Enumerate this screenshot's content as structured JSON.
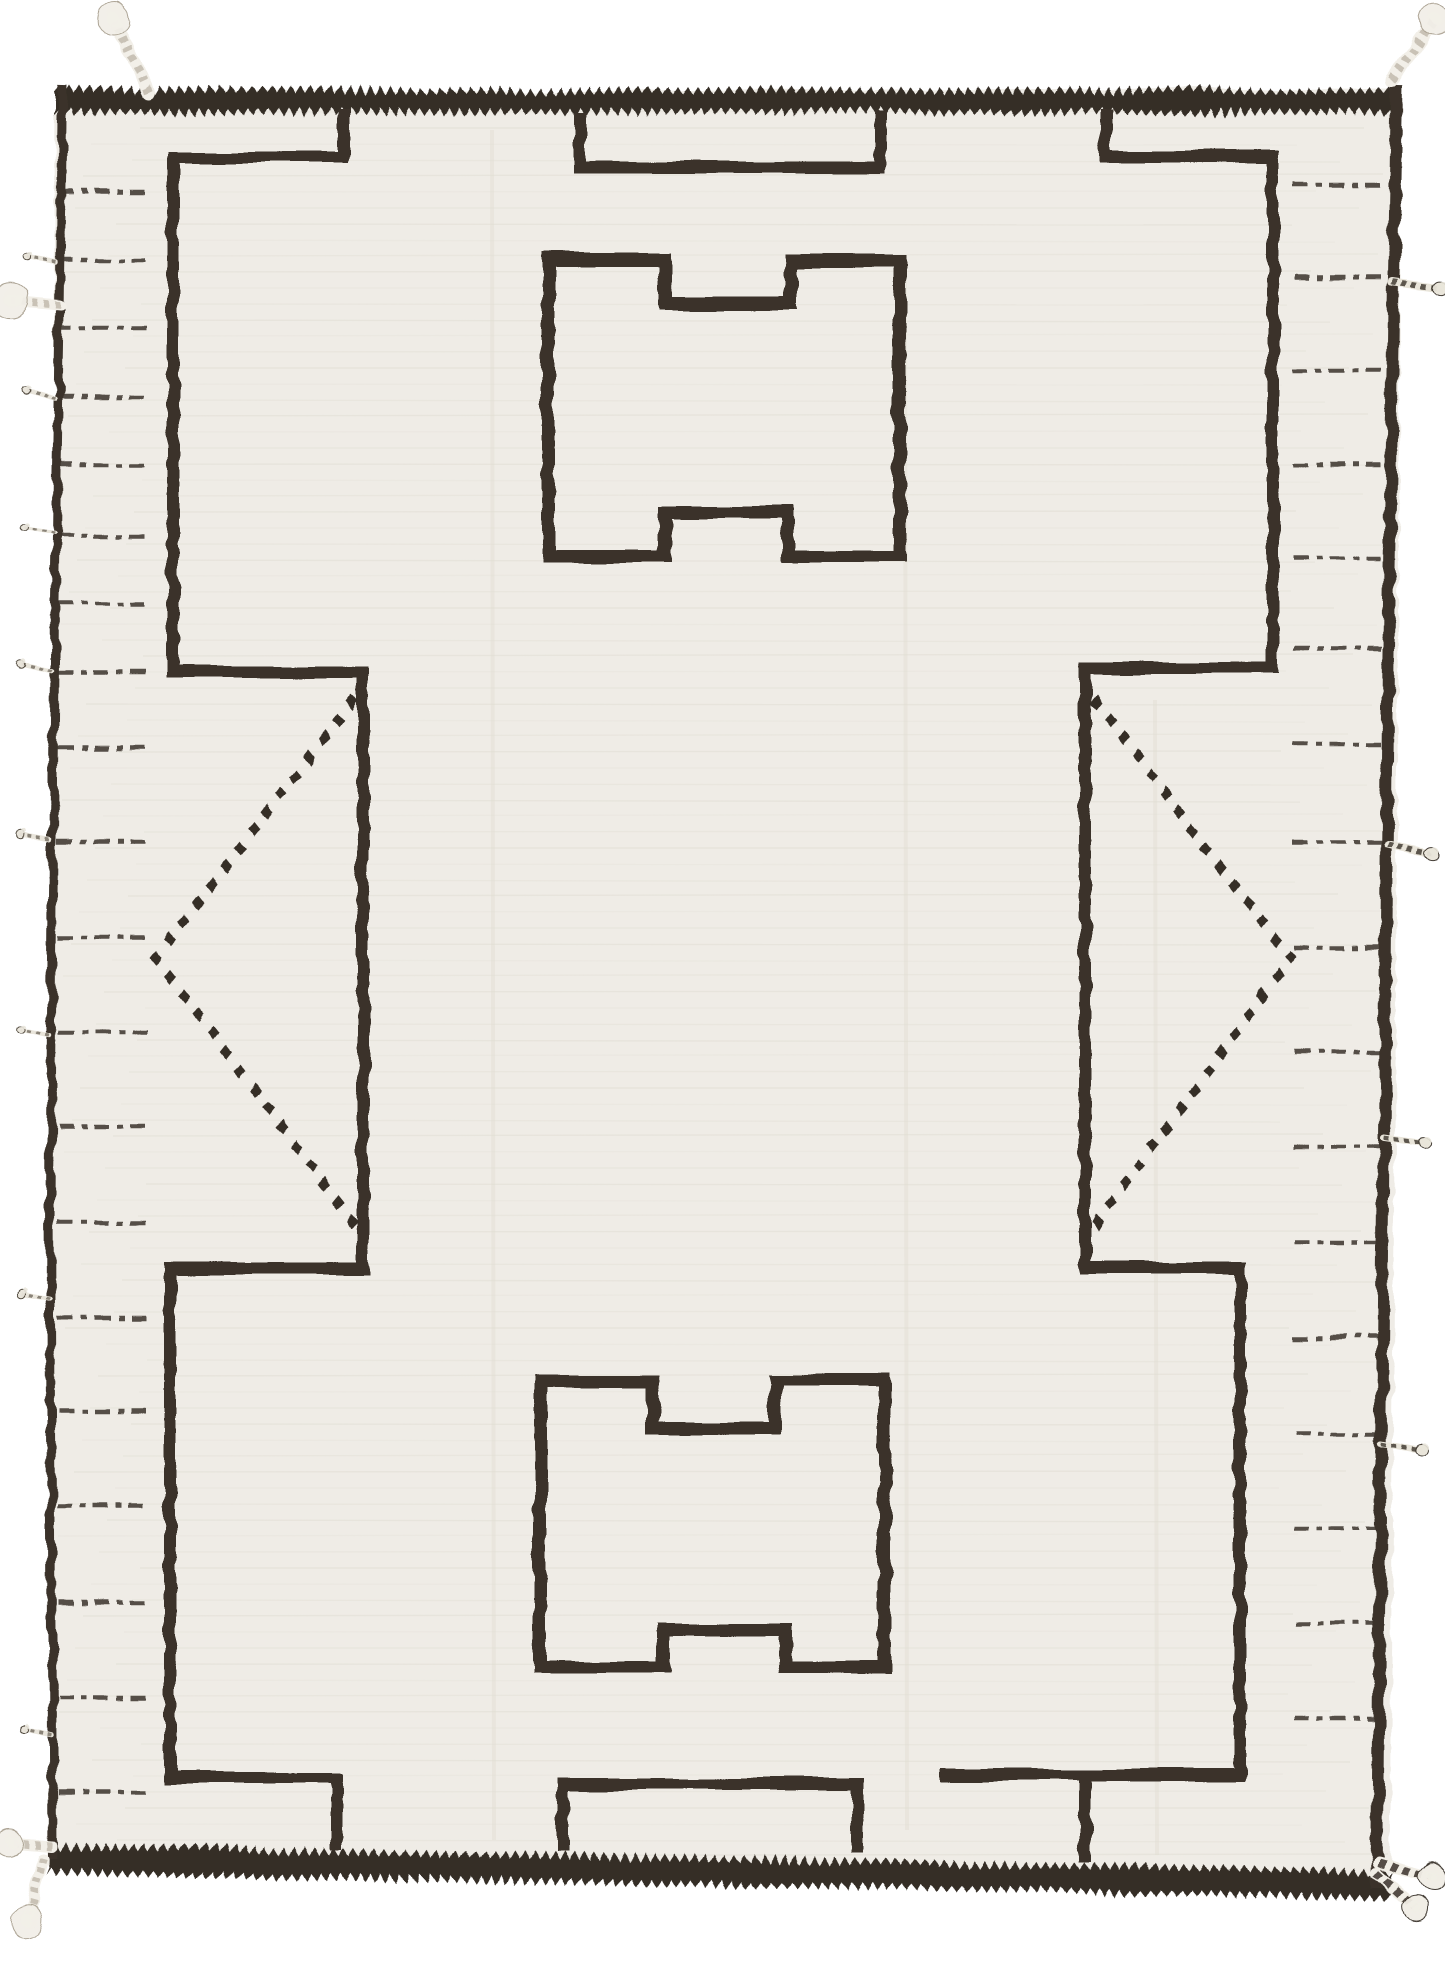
{
  "meta": {
    "title": "Moroccan Berber wool rug photograph",
    "description": "Hand-knotted ivory wool rug with charcoal-brown geometric linework: sawtooth border bands, stepped frame lines, two crenellated H-medallions, facing diamond chevrons, dashed margin ticks and braided corner tassels."
  },
  "canvas": {
    "w": 1445,
    "h": 1965,
    "background": "#ffffff"
  },
  "palette": {
    "ivory": "#efece6",
    "weave": "#d9d5ca",
    "crease": "#e2ded3",
    "charcoal": "#352e26",
    "line": "#3a332a",
    "fringe_light": "#f2efe8",
    "fringe_shadow": "#a89f8f",
    "fringe_dark": "#3a332b"
  },
  "rug": {
    "outline": [
      [
        55,
        92
      ],
      [
        1402,
        88
      ],
      [
        1390,
        1890
      ],
      [
        48,
        1866
      ]
    ]
  },
  "borders": {
    "top_band": {
      "x0": 55,
      "x1": 1400,
      "y0": 86,
      "y1": 116,
      "tooth": 8,
      "pitch": 10
    },
    "bottom_band": {
      "x0": 50,
      "x1": 1392,
      "y0": 1842,
      "y1": 1876,
      "tooth": 8,
      "pitch": 10,
      "tilt": 1.1,
      "cx": 50,
      "cy": 1842
    }
  },
  "lines": [
    {
      "name": "left-edge-binding",
      "pts": [
        [
          63,
          86
        ],
        [
          55,
          600
        ],
        [
          50,
          1200
        ],
        [
          53,
          1858
        ]
      ],
      "w": 9
    },
    {
      "name": "right-edge-binding",
      "pts": [
        [
          1397,
          84
        ],
        [
          1389,
          600
        ],
        [
          1383,
          1250
        ],
        [
          1377,
          1888
        ]
      ],
      "w": 12
    },
    {
      "name": "left-frame-line",
      "pts": [
        [
          343,
          110
        ],
        [
          343,
          157
        ],
        [
          173,
          157
        ],
        [
          173,
          672
        ],
        [
          363,
          672
        ],
        [
          363,
          1268
        ],
        [
          170,
          1268
        ],
        [
          170,
          1778
        ],
        [
          337,
          1778
        ],
        [
          337,
          1850
        ]
      ],
      "w": 12
    },
    {
      "name": "right-frame-line",
      "pts": [
        [
          1105,
          110
        ],
        [
          1105,
          157
        ],
        [
          1273,
          157
        ],
        [
          1273,
          668
        ],
        [
          1085,
          668
        ],
        [
          1085,
          1268
        ],
        [
          1240,
          1268
        ],
        [
          1240,
          1775
        ],
        [
          941,
          1775
        ]
      ],
      "w": 12
    },
    {
      "name": "right-frame-foot",
      "pts": [
        [
          1085,
          1775
        ],
        [
          1085,
          1862
        ]
      ],
      "w": 12
    },
    {
      "name": "top-niche-motif",
      "pts": [
        [
          580,
          112
        ],
        [
          580,
          168
        ],
        [
          880,
          168
        ],
        [
          880,
          112
        ]
      ],
      "w": 12
    },
    {
      "name": "bottom-niche-motif",
      "pts": [
        [
          563,
          1852
        ],
        [
          563,
          1784
        ],
        [
          857,
          1784
        ],
        [
          857,
          1852
        ]
      ],
      "w": 12
    },
    {
      "name": "top-medallion-motif",
      "pts": [
        [
          548,
          260
        ],
        [
          665,
          260
        ],
        [
          665,
          303
        ],
        [
          790,
          303
        ],
        [
          790,
          260
        ],
        [
          900,
          260
        ],
        [
          900,
          556
        ],
        [
          788,
          556
        ],
        [
          788,
          512
        ],
        [
          665,
          512
        ],
        [
          665,
          556
        ],
        [
          548,
          556
        ]
      ],
      "w": 13,
      "closed": true
    },
    {
      "name": "bottom-medallion-motif",
      "pts": [
        [
          540,
          1382
        ],
        [
          653,
          1382
        ],
        [
          653,
          1428
        ],
        [
          775,
          1428
        ],
        [
          775,
          1380
        ],
        [
          885,
          1380
        ],
        [
          885,
          1668
        ],
        [
          785,
          1668
        ],
        [
          785,
          1630
        ],
        [
          663,
          1630
        ],
        [
          663,
          1668
        ],
        [
          540,
          1668
        ]
      ],
      "w": 13,
      "closed": true
    }
  ],
  "chevrons": [
    {
      "name": "left-diamond-chevron",
      "pts": [
        [
          352,
          702
        ],
        [
          156,
          958
        ],
        [
          352,
          1222
        ]
      ],
      "per_leg": 15,
      "rx": 6,
      "ry": 7.5
    },
    {
      "name": "right-diamond-chevron",
      "pts": [
        [
          1096,
          702
        ],
        [
          1290,
          958
        ],
        [
          1098,
          1222
        ]
      ],
      "per_leg": 15,
      "rx": 6,
      "ry": 7.5
    }
  ],
  "dashes": {
    "stroke_w": 4.5,
    "pattern": "15 8 6 7",
    "left": {
      "x0": 58,
      "x1": 148,
      "rows": [
        192,
        260,
        328,
        397,
        465,
        535,
        603,
        672,
        748,
        842,
        937,
        1032,
        1127,
        1222,
        1317,
        1412,
        1507,
        1602,
        1697,
        1792
      ]
    },
    "right": {
      "x0": 1294,
      "x1": 1388,
      "rows": [
        185,
        278,
        371,
        464,
        557,
        650,
        745,
        843,
        948,
        1053,
        1148,
        1243,
        1338,
        1433,
        1528,
        1623,
        1718
      ]
    }
  },
  "texture": {
    "y0": 96,
    "y1": 1872,
    "step": 16,
    "creases": [
      [
        492,
        130,
        1840
      ],
      [
        905,
        270,
        1830
      ],
      [
        1155,
        700,
        1855
      ]
    ]
  },
  "tassel_styles": {
    "light": {
      "base": "#f2efe8",
      "twist": "#a89f8f",
      "dash": "5 6",
      "op": 0.55
    },
    "candy": {
      "base": "#f1eee6",
      "twist": "#3a332b",
      "dash": "7 6",
      "op": 0.85
    },
    "dark": {
      "base": "#e9e5da",
      "twist": "#3a332b",
      "dash": "5 5",
      "op": 0.8
    },
    "wisp": {
      "base": "#e9e5db",
      "twist": "#4a4236",
      "dash": "4 5",
      "op": 0.6
    }
  },
  "tassels": [
    {
      "name": "corner-tassel-top-left",
      "x": 148,
      "y": 92,
      "angle": -115,
      "len": 80,
      "w": 13,
      "style": "light",
      "tuft": 16
    },
    {
      "name": "edge-tassel-top-left",
      "x": 60,
      "y": 305,
      "angle": 185,
      "len": 50,
      "w": 11,
      "style": "light",
      "tuft": 18
    },
    {
      "name": "corner-tassel-top-right",
      "x": 1392,
      "y": 80,
      "angle": -55,
      "len": 75,
      "w": 13,
      "style": "light",
      "tuft": 16
    },
    {
      "name": "edge-fringe-right-1",
      "x": 1392,
      "y": 282,
      "angle": 8,
      "len": 48,
      "w": 8,
      "style": "dark",
      "tuft": 7
    },
    {
      "name": "edge-fringe-right-2",
      "x": 1388,
      "y": 845,
      "angle": 12,
      "len": 44,
      "w": 8,
      "style": "dark",
      "tuft": 7
    },
    {
      "name": "edge-fringe-right-3",
      "x": 1384,
      "y": 1138,
      "angle": 8,
      "len": 40,
      "w": 7,
      "style": "dark",
      "tuft": 6
    },
    {
      "name": "edge-fringe-right-4",
      "x": 1382,
      "y": 1443,
      "angle": 10,
      "len": 40,
      "w": 7,
      "style": "dark",
      "tuft": 6
    },
    {
      "name": "edge-wisp-left-1",
      "x": 56,
      "y": 263,
      "angle": 192,
      "len": 30,
      "w": 4.5,
      "style": "wisp",
      "tuft": 4
    },
    {
      "name": "edge-wisp-left-2",
      "x": 55,
      "y": 400,
      "angle": 195,
      "len": 32,
      "w": 4.5,
      "style": "wisp",
      "tuft": 4
    },
    {
      "name": "edge-wisp-left-3",
      "x": 53,
      "y": 533,
      "angle": 190,
      "len": 30,
      "w": 4.5,
      "style": "wisp",
      "tuft": 4
    },
    {
      "name": "edge-wisp-left-4",
      "x": 52,
      "y": 670,
      "angle": 193,
      "len": 32,
      "w": 4.5,
      "style": "wisp",
      "tuft": 4
    },
    {
      "name": "edge-wisp-left-5",
      "x": 51,
      "y": 840,
      "angle": 190,
      "len": 30,
      "w": 4.5,
      "style": "wisp",
      "tuft": 4
    },
    {
      "name": "edge-wisp-left-6",
      "x": 50,
      "y": 1035,
      "angle": 192,
      "len": 28,
      "w": 4.5,
      "style": "wisp",
      "tuft": 4
    },
    {
      "name": "edge-wisp-left-7",
      "x": 50,
      "y": 1300,
      "angle": 190,
      "len": 30,
      "w": 4.5,
      "style": "wisp",
      "tuft": 4
    },
    {
      "name": "edge-wisp-left-8",
      "x": 52,
      "y": 1735,
      "angle": 192,
      "len": 28,
      "w": 4.5,
      "style": "wisp",
      "tuft": 4
    },
    {
      "name": "corner-tassel-bottom-left-a",
      "x": 52,
      "y": 1846,
      "angle": 185,
      "len": 42,
      "w": 10,
      "style": "light",
      "tuft": 14
    },
    {
      "name": "corner-tassel-bottom-left-b",
      "x": 44,
      "y": 1858,
      "angle": 105,
      "len": 66,
      "w": 11,
      "style": "light",
      "tuft": 16
    },
    {
      "name": "corner-tassel-bottom-right-a",
      "x": 1378,
      "y": 1862,
      "angle": 15,
      "len": 56,
      "w": 11,
      "style": "candy",
      "tuft": 14
    },
    {
      "name": "corner-tassel-bottom-right-b",
      "x": 1376,
      "y": 1872,
      "angle": 42,
      "len": 54,
      "w": 11,
      "style": "candy",
      "tuft": 13
    }
  ]
}
